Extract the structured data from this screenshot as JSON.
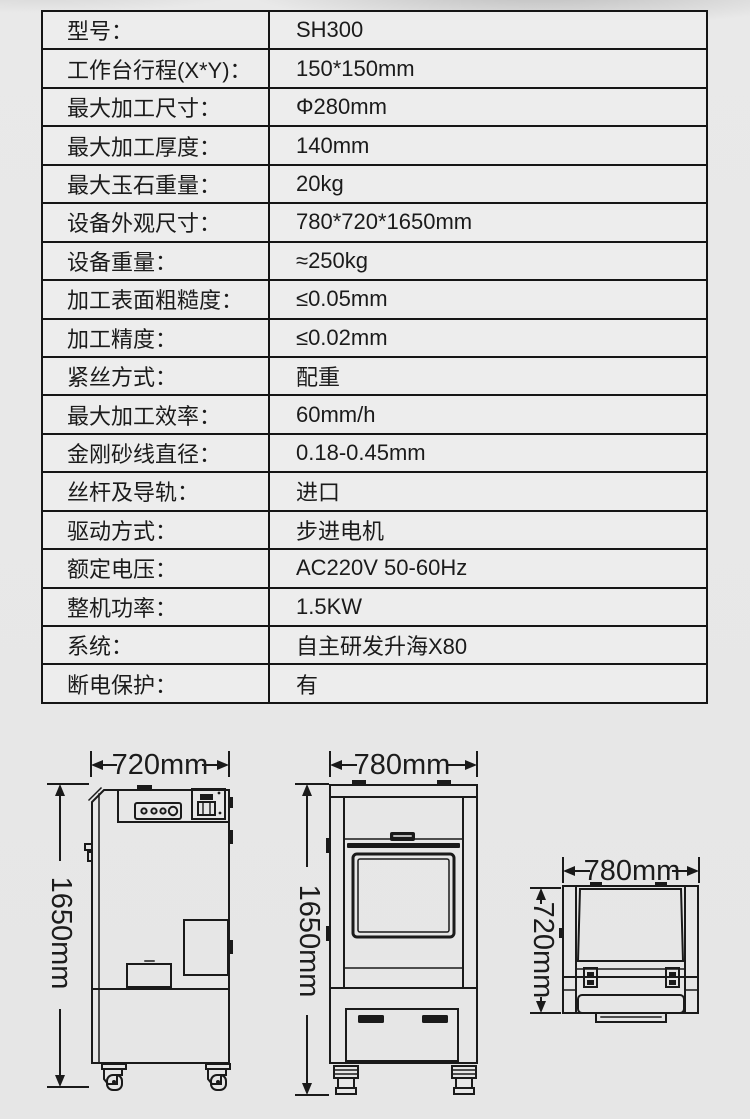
{
  "colors": {
    "line": "#1a1a1a",
    "table_background": "#ededed",
    "page_background": "#e9e9e9",
    "text": "#1b1b1b"
  },
  "spec_table": {
    "rows": [
      {
        "label": "型号：",
        "value": "SH300"
      },
      {
        "label": "工作台行程(X*Y)：",
        "value": "150*150mm"
      },
      {
        "label": "最大加工尺寸：",
        "value": "Φ280mm"
      },
      {
        "label": "最大加工厚度：",
        "value": "140mm"
      },
      {
        "label": "最大玉石重量：",
        "value": "20kg"
      },
      {
        "label": "设备外观尺寸：",
        "value": "780*720*1650mm"
      },
      {
        "label": "设备重量：",
        "value": "≈250kg"
      },
      {
        "label": "加工表面粗糙度：",
        "value": "≤0.05mm"
      },
      {
        "label": "加工精度：",
        "value": "≤0.02mm"
      },
      {
        "label": "紧丝方式：",
        "value": "配重"
      },
      {
        "label": "最大加工效率：",
        "value": "60mm/h"
      },
      {
        "label": "金刚砂线直径：",
        "value": "0.18-0.45mm"
      },
      {
        "label": "丝杆及导轨：",
        "value": "进口"
      },
      {
        "label": "驱动方式：",
        "value": "步进电机"
      },
      {
        "label": "额定电压：",
        "value": "AC220V 50-60Hz"
      },
      {
        "label": "整机功率：",
        "value": "1.5KW"
      },
      {
        "label": "系统：",
        "value": "自主研发升海X80"
      },
      {
        "label": "断电保护：",
        "value": "有"
      }
    ]
  },
  "drawings": {
    "side_view": {
      "width_label": "720mm",
      "height_label": "1650mm"
    },
    "front_view": {
      "width_label": "780mm",
      "height_label": "1650mm"
    },
    "top_view": {
      "width_label": "780mm",
      "height_label": "720mm"
    }
  }
}
